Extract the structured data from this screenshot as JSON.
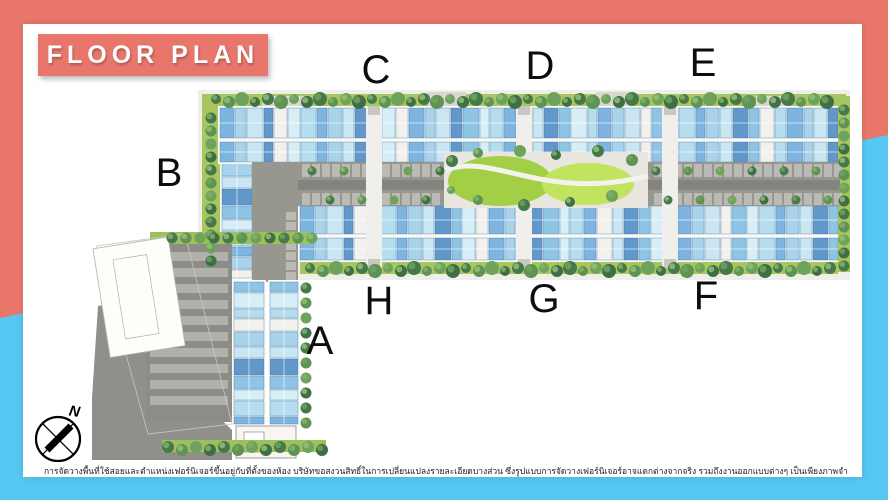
{
  "header": {
    "title": "FLOOR PLAN"
  },
  "plan": {
    "building_labels": [
      {
        "text": "A"
      },
      {
        "text": "B"
      },
      {
        "text": "C"
      },
      {
        "text": "D"
      },
      {
        "text": "E"
      },
      {
        "text": "F"
      },
      {
        "text": "G"
      },
      {
        "text": "H"
      }
    ]
  },
  "compass": {
    "north_label": "N"
  },
  "footer": {
    "disclaimer": "การจัดวางพื้นที่ใช้สอยและตำแหน่งเฟอร์นิเจอร์ขึ้นอยู่กับที่ตั้งของห้อง บริษัทขอสงวนสิทธิ์ในการเปลี่ยนแปลงรายละเอียดบางส่วน ซึ่งรูปแบบการจัดวางเฟอร์นิเจอร์อาจแตกต่างจากจริง รวมถึงงานออกแบบต่างๆ เป็นเพียงภาพจำลองบรรยากาศการจัดวางพื้นที่ใช้สอยและเพื่อการโฆษณาเท่านั้น"
  },
  "colors": {
    "coral_accent": "#E8766B",
    "sky_blue_accent": "#56C7F0",
    "card_background": "#FFFFFF",
    "label_text": "#0D0D0D"
  }
}
